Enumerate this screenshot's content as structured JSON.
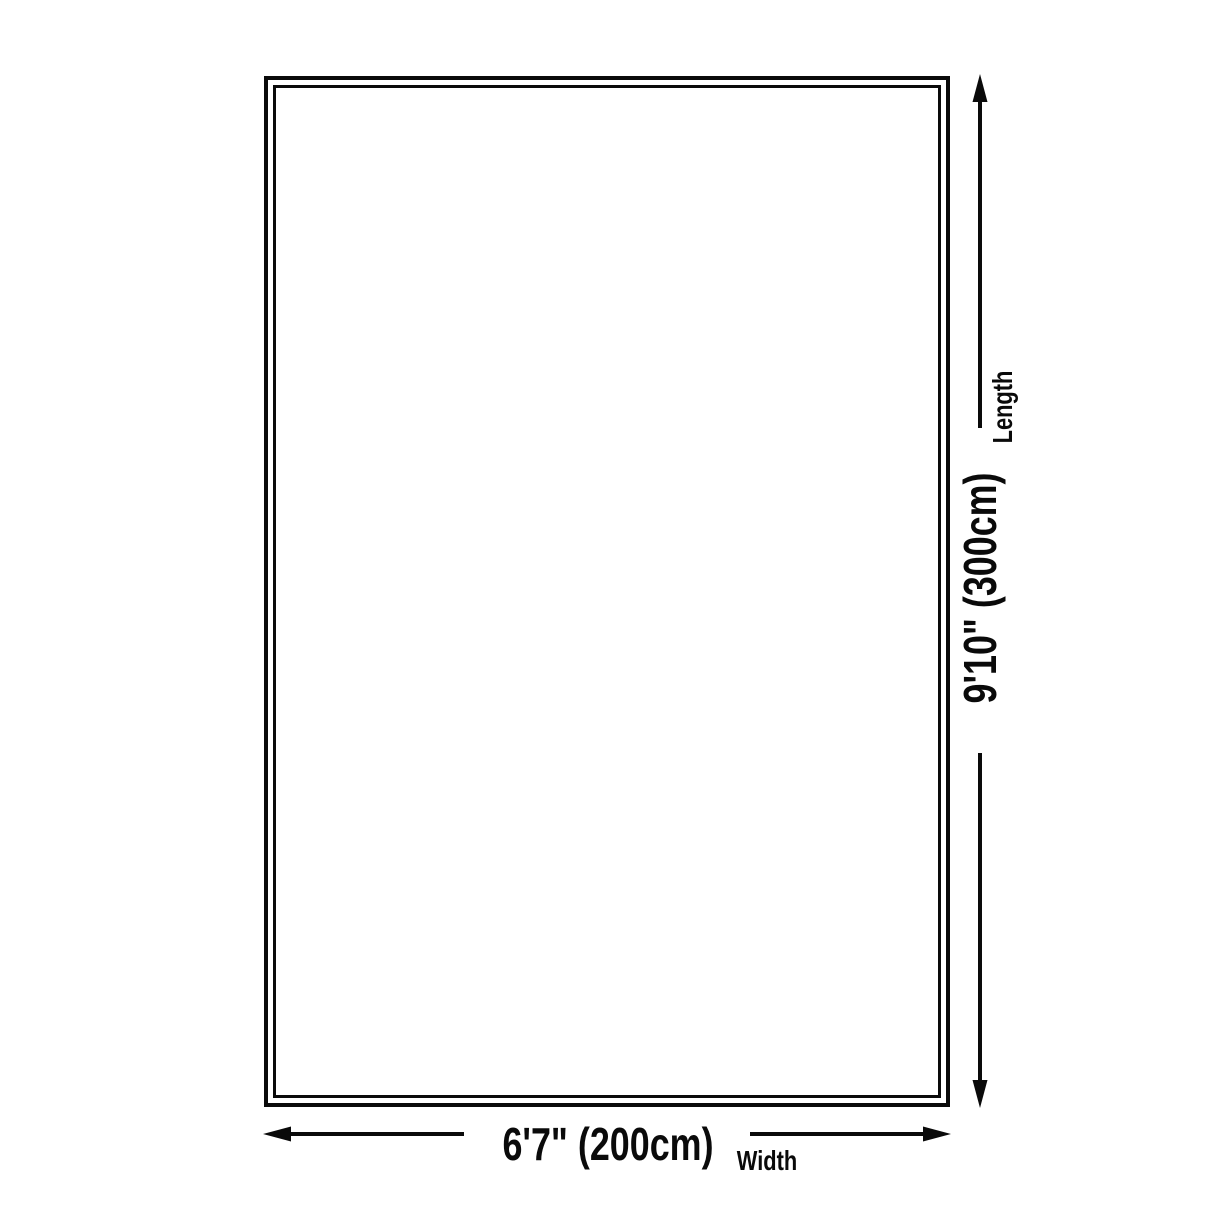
{
  "diagram": {
    "type": "product-size-diagram",
    "background_color": "#ffffff",
    "line_color": "#0a0a0a",
    "rug_outline_style": "double-border rectangle",
    "length": {
      "value": "9'10\" (300cm)",
      "label": "Length"
    },
    "width": {
      "value": "6'7\" (200cm)",
      "label": "Width"
    }
  }
}
